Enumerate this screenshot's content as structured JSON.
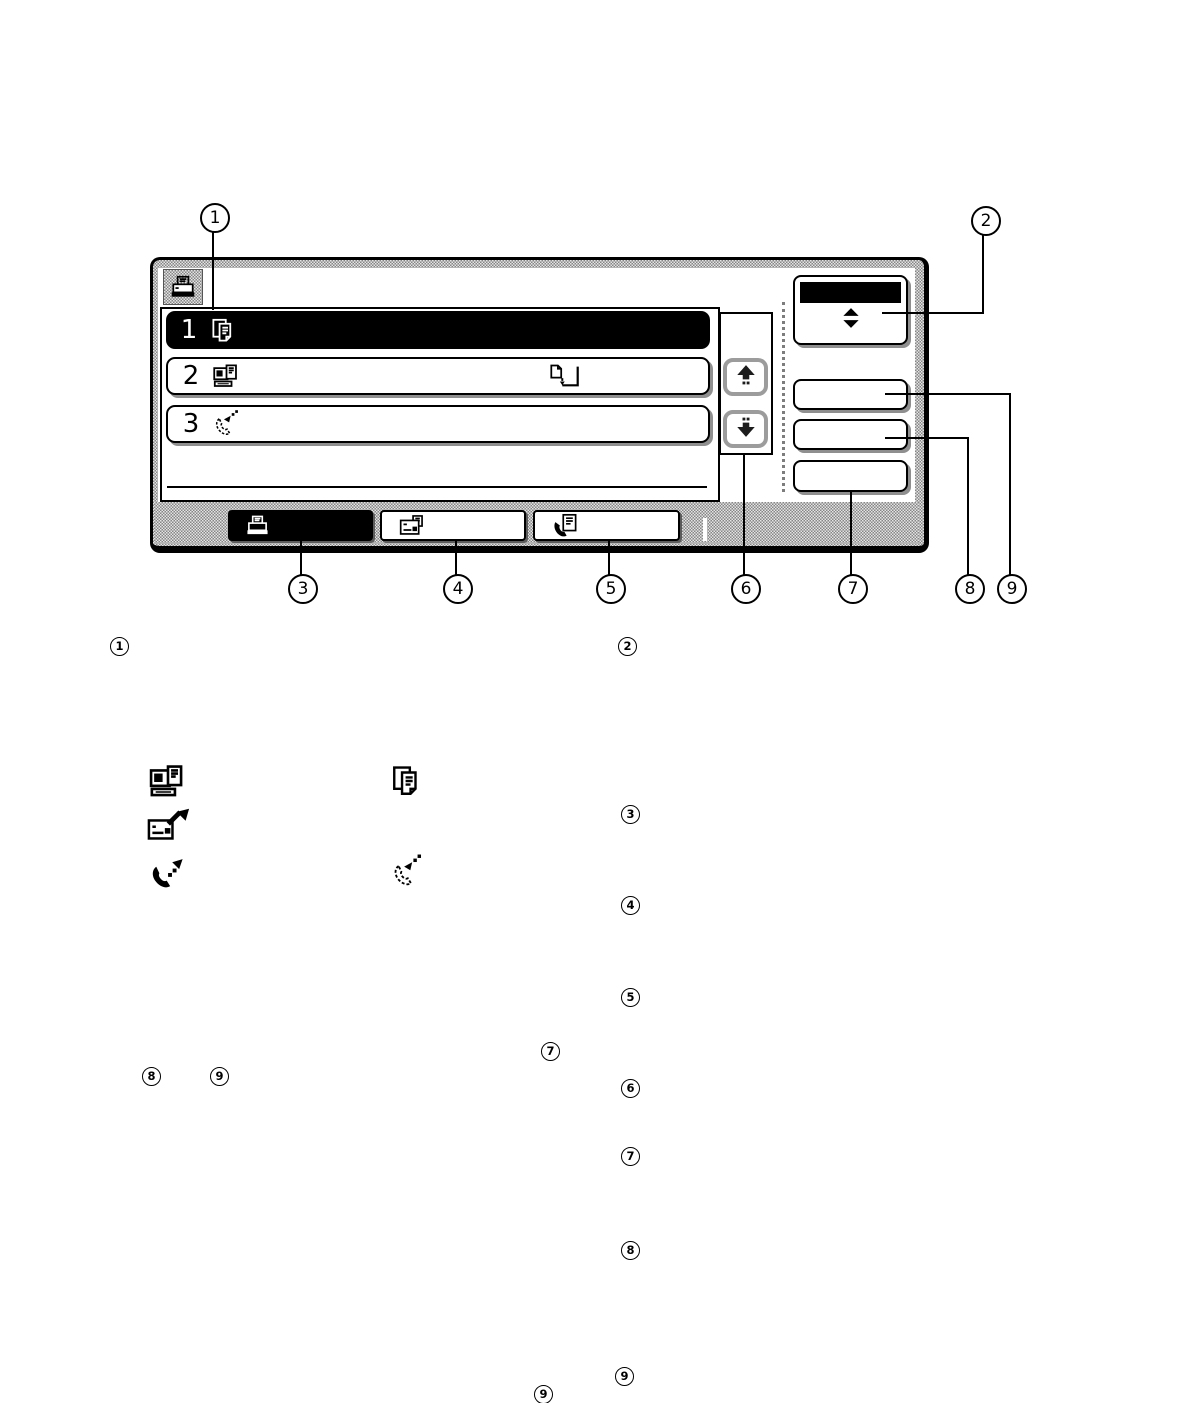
{
  "colors": {
    "ink": "#000000",
    "paper": "#ffffff",
    "bezel_gray": "#9a9a9a",
    "selected_row": "#000000"
  },
  "panel": {
    "header_icon": "printer-icon",
    "job_list": {
      "rows": [
        {
          "number": "1",
          "job_icon": "copy-job-icon",
          "selected": true
        },
        {
          "number": "2",
          "job_icon": "computer-print-job-icon",
          "status_icon": "spooling-document-icon",
          "selected": false
        },
        {
          "number": "3",
          "job_icon": "incoming-call-icon",
          "selected": false
        }
      ]
    },
    "scroll_buttons": {
      "up_icon": "scroll-up-arrow-icon",
      "down_icon": "scroll-down-arrow-icon"
    },
    "side_buttons": {
      "job_switch_icon": "job-switch-arrows-icon",
      "blank_button_count": 3
    },
    "mode_tabs": [
      {
        "icon": "printer-icon",
        "selected": true
      },
      {
        "icon": "fax-document-icon",
        "selected": false
      },
      {
        "icon": "phone-document-icon",
        "selected": false
      }
    ]
  },
  "callouts": {
    "top": [
      {
        "label": "1"
      },
      {
        "label": "2"
      }
    ],
    "bottom": [
      {
        "label": "3"
      },
      {
        "label": "4"
      },
      {
        "label": "5"
      },
      {
        "label": "6"
      },
      {
        "label": "7"
      },
      {
        "label": "8"
      },
      {
        "label": "9"
      }
    ]
  },
  "markers": [
    {
      "label": "1"
    },
    {
      "label": "2"
    },
    {
      "label": "3"
    },
    {
      "label": "4"
    },
    {
      "label": "5"
    },
    {
      "label": "7"
    },
    {
      "label": "8"
    },
    {
      "label": "9"
    },
    {
      "label": "6"
    },
    {
      "label": "7"
    },
    {
      "label": "8"
    },
    {
      "label": "9"
    },
    {
      "label": "9"
    }
  ],
  "legend_icons": [
    "computer-print-job-icon",
    "copy-job-icon",
    "send-document-icon",
    "outgoing-call-icon",
    "incoming-call-icon"
  ]
}
